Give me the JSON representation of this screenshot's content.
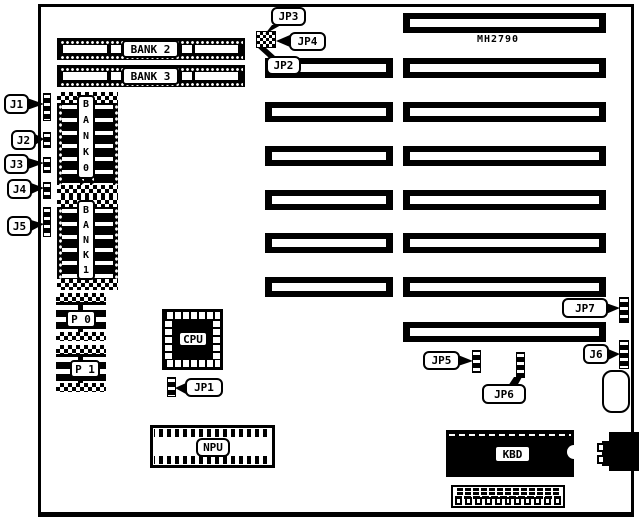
{
  "board": {
    "model": "MH2790"
  },
  "memory": {
    "bank2": "BANK 2",
    "bank3": "BANK 3",
    "bank0": "B\nA\nN\nK\n0",
    "bank1": "B\nA\nN\nK\n1",
    "p0": "P 0",
    "p1": "P 1"
  },
  "chips": {
    "cpu": "CPU",
    "npu": "NPU",
    "kbd": "KBD"
  },
  "jumpers": {
    "jp1": "JP1",
    "jp2": "JP2",
    "jp3": "JP3",
    "jp4": "JP4",
    "jp5": "JP5",
    "jp6": "JP6",
    "jp7": "JP7"
  },
  "connectors": {
    "j1": "J1",
    "j2": "J2",
    "j3": "J3",
    "j4": "J4",
    "j5": "J5",
    "j6": "J6"
  },
  "colors": {
    "ink": "#000000",
    "paper": "#ffffff"
  }
}
